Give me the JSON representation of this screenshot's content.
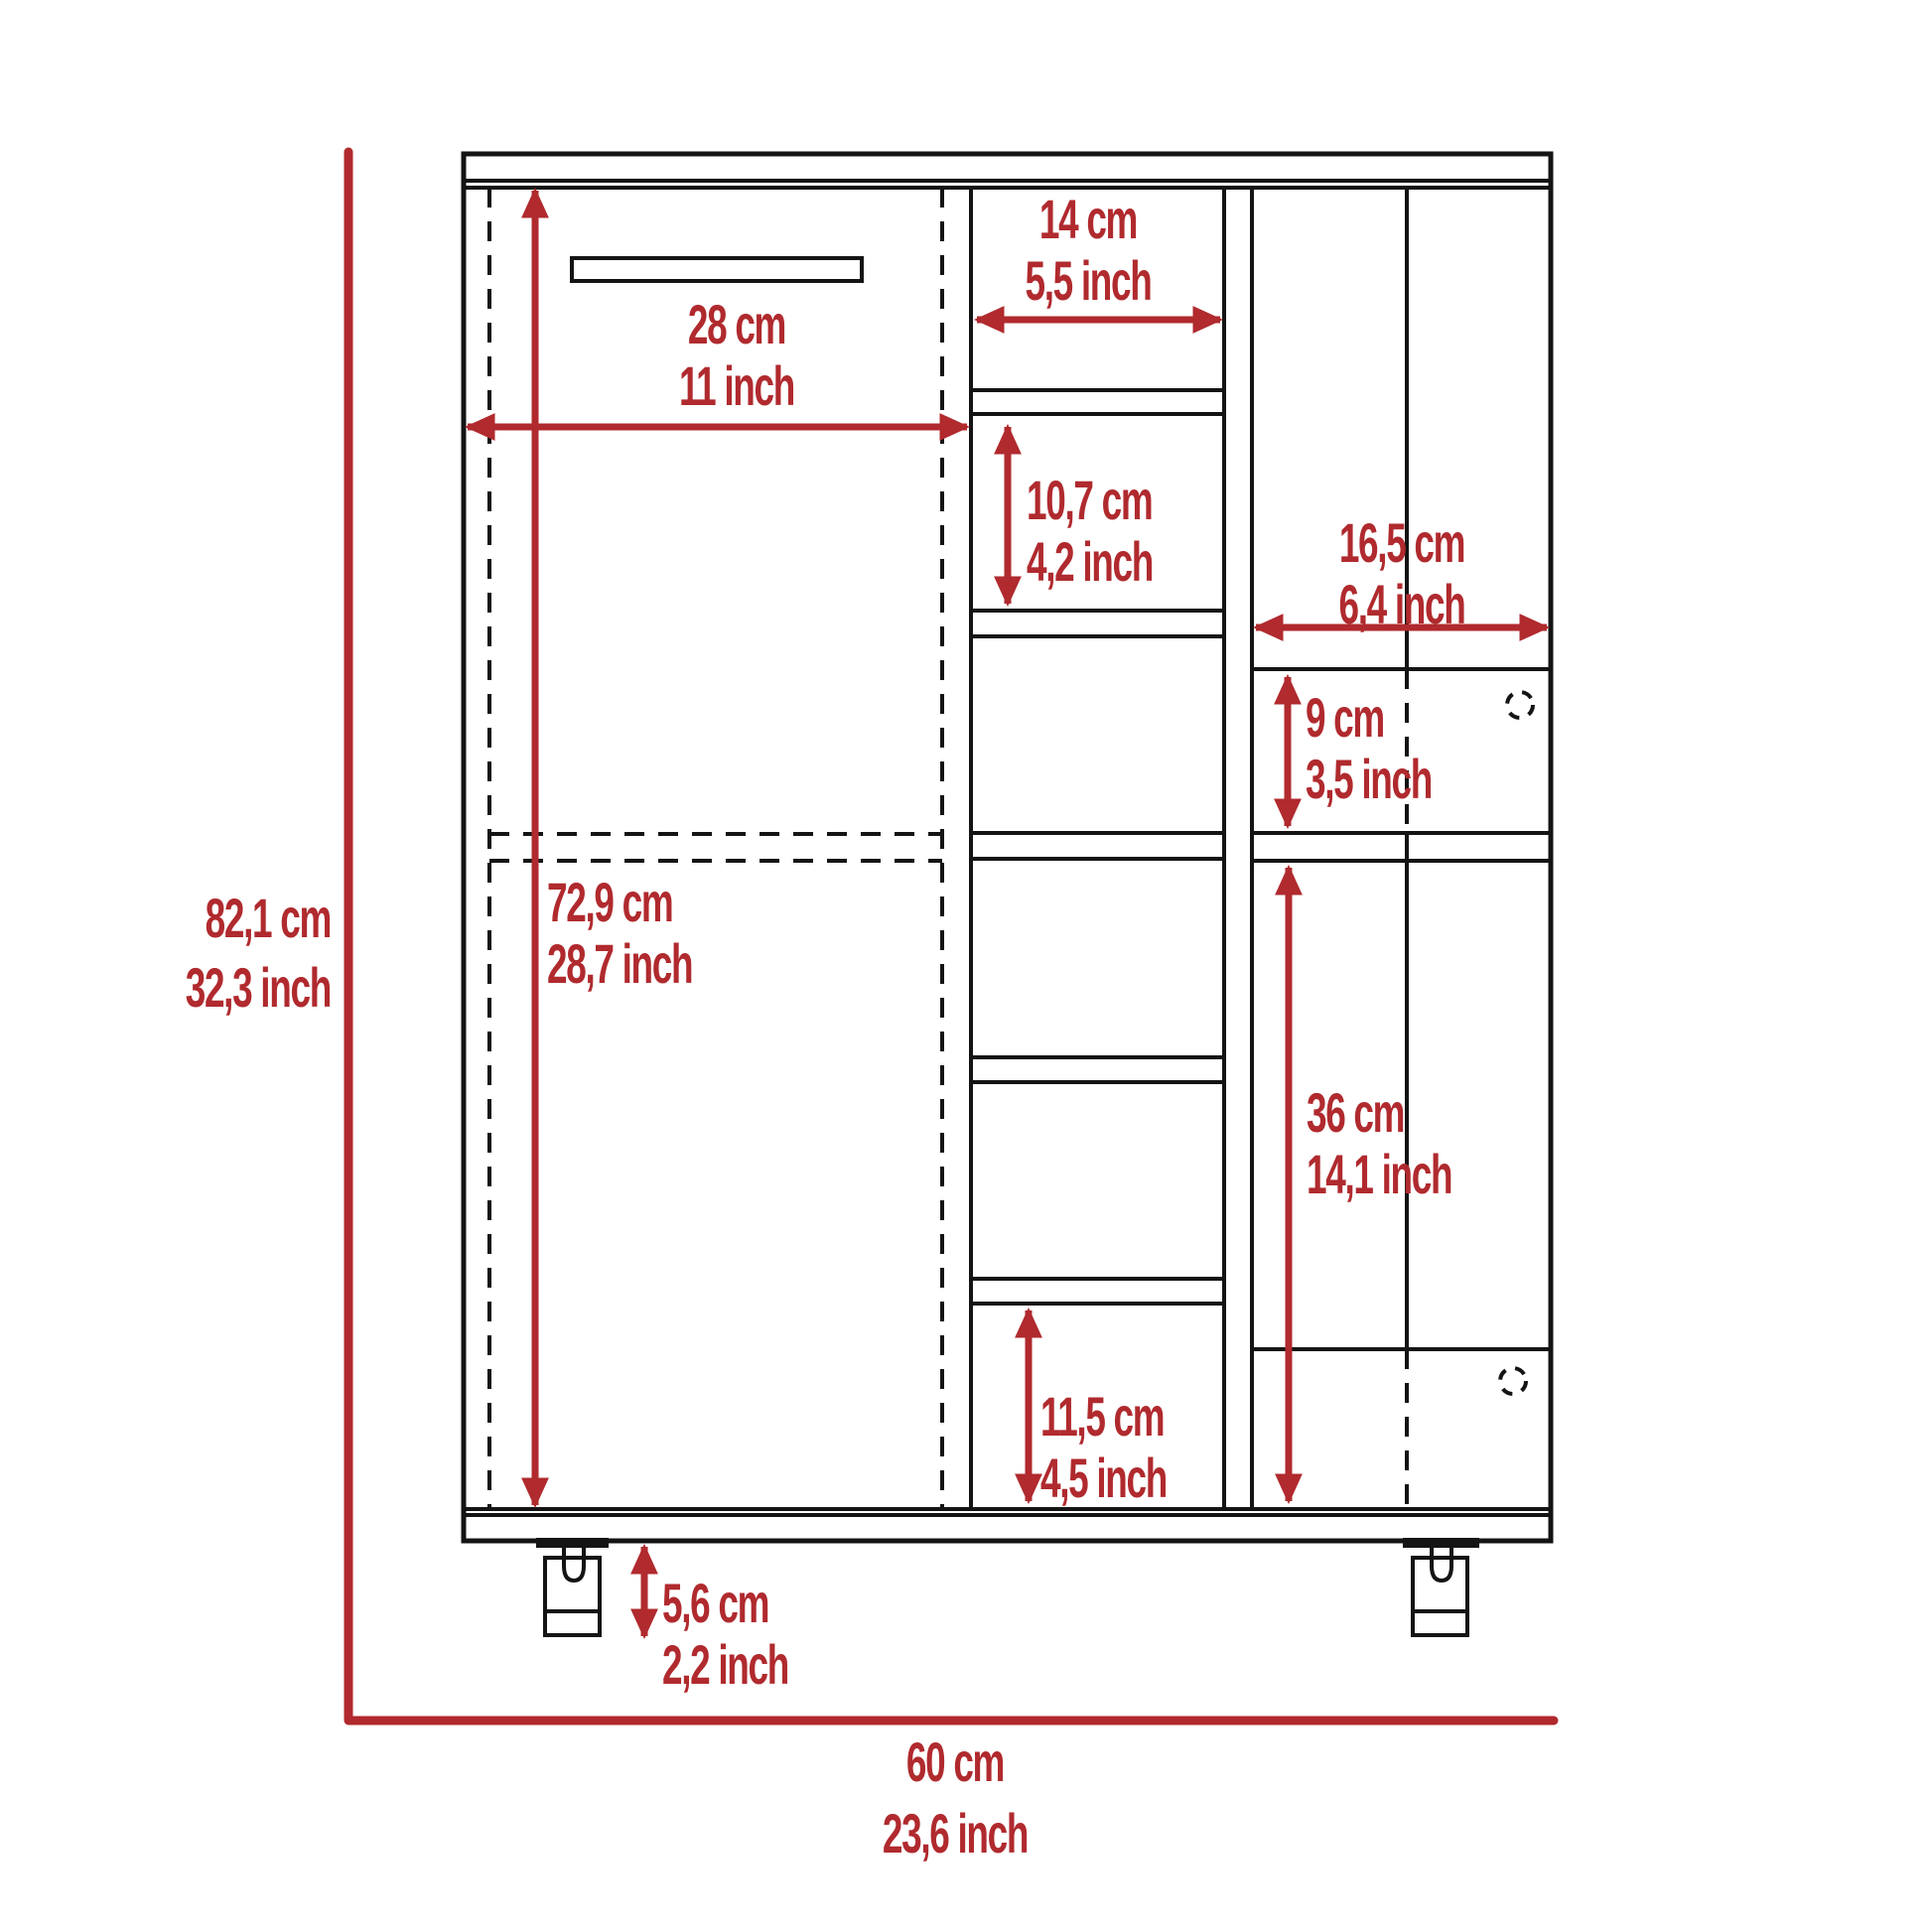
{
  "diagram": {
    "kind": "furniture dimension drawing",
    "subject": "bar cart cabinet, front elevation with casters",
    "colors": {
      "accent": "#b02a2e",
      "line": "#141414",
      "background": "#ffffff"
    }
  },
  "labels": {
    "overall_height": {
      "cm": "82,1 cm",
      "inch": "32,3 inch"
    },
    "overall_width": {
      "cm": "60 cm",
      "inch": "23,6 inch"
    },
    "left_door_width": {
      "cm": "28 cm",
      "inch": "11 inch"
    },
    "left_door_height": {
      "cm": "72,9 cm",
      "inch": "28,7 inch"
    },
    "bottle_cubby_width": {
      "cm": "14 cm",
      "inch": "5,5 inch"
    },
    "bottle_cubby_height": {
      "cm": "10,7 cm",
      "inch": "4,2 inch"
    },
    "right_section_width": {
      "cm": "16,5 cm",
      "inch": "6,4 inch"
    },
    "upper_right_door_height": {
      "cm": "9 cm",
      "inch": "3,5 inch"
    },
    "lower_right_door_height": {
      "cm": "36 cm",
      "inch": "14,1 inch"
    },
    "bottom_cubby_height": {
      "cm": "11,5 cm",
      "inch": "4,5 inch"
    },
    "caster_height": {
      "cm": "5,6 cm",
      "inch": "2,2 inch"
    }
  }
}
